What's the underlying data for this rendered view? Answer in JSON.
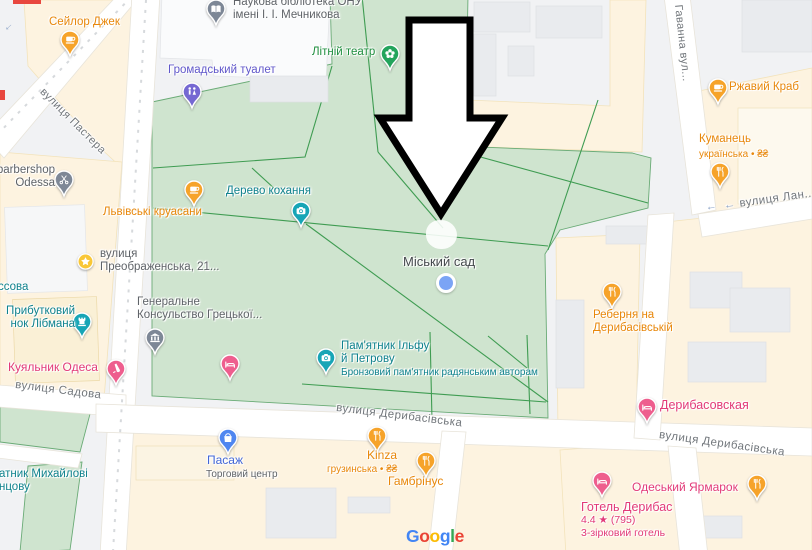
{
  "map": {
    "attribution": {
      "logo_text": "Google",
      "letter_colors": [
        "#4285F4",
        "#EA4335",
        "#FBBC05",
        "#4285F4",
        "#34A853",
        "#EA4335"
      ]
    },
    "annotation": {
      "shape": "arrow",
      "direction": "down",
      "fill": "#ffffff",
      "outline": "#000000"
    },
    "location_dot": {
      "x": 446,
      "y": 283,
      "color": "#7ba4f5"
    },
    "area_labels": [
      {
        "id": "miskyi-sad",
        "text": "Міський сад",
        "x": 403,
        "y": 254,
        "size": 13,
        "color": "#45494d"
      }
    ],
    "street_labels": [
      {
        "id": "pastera",
        "text": "вулиця Пастера",
        "x": 46,
        "y": 86,
        "rotate": 45,
        "size": 11
      },
      {
        "id": "havanna",
        "text": "Гаванна вул...",
        "x": 684,
        "y": 4,
        "rotate": 84,
        "size": 11
      },
      {
        "id": "lan",
        "text": "вулиця Лан...",
        "x": 723,
        "y": 200,
        "rotate": -8,
        "size": 11.5,
        "arrow": true
      },
      {
        "id": "sadova",
        "text": "вулиця Садова",
        "x": 16,
        "y": 379,
        "rotate": 7,
        "size": 11.5
      },
      {
        "id": "derybasivska-center",
        "text": "вулиця Дерибасівська",
        "x": 337,
        "y": 402,
        "rotate": 7,
        "size": 11.5
      },
      {
        "id": "derybasivska-right",
        "text": "вулиця Дерибасівська",
        "x": 660,
        "y": 429,
        "rotate": 8,
        "size": 11.5
      }
    ],
    "oneway_arrows": [
      {
        "x": 4,
        "y": 22,
        "rotate": 137
      },
      {
        "x": 706,
        "y": 203,
        "rotate": 172
      }
    ],
    "pois": [
      {
        "id": "seilor-dzhek",
        "icon": "cafe",
        "pin": {
          "x": 70,
          "y": 40,
          "color": "#f6a32a"
        },
        "labels": [
          {
            "x": 49,
            "y": 16,
            "color": "#e8870a",
            "size": 11.5,
            "lines": [
              "Сейлор Джек"
            ]
          }
        ]
      },
      {
        "id": "naukova-biblioteka",
        "icon": "book",
        "pin": {
          "x": 216,
          "y": 9,
          "color": "#7d8796"
        },
        "labels": [
          {
            "x": 233,
            "y": -4,
            "color": "#5f6368",
            "size": 11.5,
            "lines": [
              "Наукова бібліотека ОНУ",
              "імені І. І. Мечникова"
            ]
          }
        ]
      },
      {
        "id": "hromadskyi-tualet",
        "icon": "toilet",
        "pin": {
          "x": 192,
          "y": 92,
          "color": "#7568d2"
        },
        "labels": [
          {
            "x": 168,
            "y": 64,
            "color": "#6057ca",
            "size": 11.5,
            "lines": [
              "Громадський туалет"
            ]
          }
        ]
      },
      {
        "id": "litnii-teatr",
        "icon": "flower",
        "pin": {
          "x": 390,
          "y": 54,
          "color": "#23a45c"
        },
        "labels": [
          {
            "x": 312,
            "y": 46,
            "color": "#1e8e3e",
            "size": 11.5,
            "lines": [
              "Літній театр"
            ]
          }
        ]
      },
      {
        "id": "rzhavyi-krab",
        "icon": "cafe",
        "pin": {
          "x": 718,
          "y": 88,
          "color": "#f6a32a"
        },
        "labels": [
          {
            "x": 729,
            "y": 81,
            "color": "#e8870a",
            "size": 11.5,
            "lines": [
              "Ржавий Краб"
            ]
          }
        ]
      },
      {
        "id": "kumanets",
        "icon": "restaurant",
        "pin": {
          "x": 720,
          "y": 172,
          "color": "#f6a32a"
        },
        "labels": [
          {
            "x": 699,
            "y": 133,
            "color": "#e8870a",
            "size": 11.5,
            "lines": [
              "Куманець"
            ]
          },
          {
            "x": 699,
            "y": 149,
            "color": "#e8870a",
            "size": 10,
            "weight": 400,
            "lines": [
              "українська • ₴₴"
            ]
          }
        ]
      },
      {
        "id": "lvivski-kruasany",
        "icon": "cafe",
        "pin": {
          "x": 194,
          "y": 190,
          "color": "#f6a32a"
        },
        "labels": [
          {
            "x": 103,
            "y": 206,
            "color": "#e8870a",
            "size": 11.5,
            "lines": [
              "Львівські круасани"
            ]
          }
        ]
      },
      {
        "id": "barbershop-odessa",
        "icon": "scissors",
        "pin": {
          "x": 64,
          "y": 180,
          "color": "#7d8796"
        },
        "labels": [
          {
            "x": -60,
            "y": 164,
            "w": 115,
            "align": "right",
            "color": "#5f6368",
            "size": 11.5,
            "lines": [
              "barbershop",
              "Odessa"
            ]
          }
        ]
      },
      {
        "id": "vulytsia-preobrazhenska-21",
        "icon": "star",
        "pin": {
          "x": 85,
          "y": 261,
          "color": "#f9c737"
        },
        "labels": [
          {
            "x": 100,
            "y": 248,
            "color": "#5f6368",
            "size": 11.5,
            "lines": [
              "вулиця",
              "Преображенська, 21..."
            ]
          }
        ]
      },
      {
        "id": "derevo-kokhannia",
        "icon": "camera",
        "pin": {
          "x": 301,
          "y": 211,
          "color": "#17a5b6"
        },
        "labels": [
          {
            "x": 226,
            "y": 185,
            "color": "#0f828d",
            "size": 11.5,
            "lines": [
              "Дерево кохання"
            ]
          }
        ]
      },
      {
        "id": "ssova-partial",
        "icon": null,
        "pin": null,
        "labels": [
          {
            "x": -2,
            "y": 281,
            "color": "#0f828d",
            "size": 11.5,
            "lines": [
              "ссова"
            ]
          }
        ]
      },
      {
        "id": "prybutkovyi-budynok-libmana",
        "icon": "castle",
        "pin": {
          "x": 82,
          "y": 322,
          "color": "#17a5b6"
        },
        "labels": [
          {
            "x": -41,
            "y": 305,
            "w": 116,
            "align": "right",
            "color": "#0f828d",
            "size": 11.5,
            "lines": [
              "Прибутковий",
              "нок Лібмана"
            ]
          }
        ]
      },
      {
        "id": "heneralne-konsulstvo-hretskoi",
        "icon": "bank",
        "pin": {
          "x": 155,
          "y": 338,
          "color": "#7d8796"
        },
        "labels": [
          {
            "x": 137,
            "y": 296,
            "color": "#5f6368",
            "size": 11.5,
            "lines": [
              "Генеральне",
              "Консульство Грецької..."
            ]
          }
        ]
      },
      {
        "id": "kuialnyk-odesa",
        "icon": "bottle",
        "pin": {
          "x": 116,
          "y": 369,
          "color": "#ee5e8e"
        },
        "labels": [
          {
            "x": 8,
            "y": 361,
            "color": "#e23a78",
            "size": 12,
            "lines": [
              "Куяльник Одеса"
            ]
          }
        ]
      },
      {
        "id": "hotel-pin-unlabeled",
        "icon": "bed",
        "pin": {
          "x": 230,
          "y": 364,
          "color": "#ee5e8e"
        },
        "labels": []
      },
      {
        "id": "pamiatnyk-ilfu-i-petrovu",
        "icon": "camera",
        "pin": {
          "x": 326,
          "y": 358,
          "color": "#17a5b6"
        },
        "labels": [
          {
            "x": 341,
            "y": 340,
            "color": "#0f828d",
            "size": 11.5,
            "lines": [
              "Пам'ятник Ільфу",
              "й Петрову"
            ]
          },
          {
            "x": 341,
            "y": 367,
            "color": "#0f828d",
            "size": 10,
            "weight": 400,
            "lines": [
              "Бронзовий пам'ятник радянським авторам"
            ]
          }
        ]
      },
      {
        "id": "rebernia-na-derybasivskii",
        "icon": "restaurant",
        "pin": {
          "x": 612,
          "y": 292,
          "color": "#f6a32a"
        },
        "labels": [
          {
            "x": 593,
            "y": 309,
            "color": "#e8870a",
            "size": 11.5,
            "lines": [
              "Реберня на",
              "Дерибасівській"
            ]
          }
        ]
      },
      {
        "id": "derybasovskaia",
        "icon": "bed",
        "pin": {
          "x": 647,
          "y": 407,
          "color": "#ee5e8e"
        },
        "labels": [
          {
            "x": 660,
            "y": 398,
            "color": "#e23a78",
            "size": 12.5,
            "lines": [
              "Дерибасовская"
            ]
          }
        ]
      },
      {
        "id": "pasazh",
        "icon": "bag",
        "pin": {
          "x": 228,
          "y": 438,
          "color": "#4f86f0"
        },
        "labels": [
          {
            "x": 207,
            "y": 454,
            "color": "#4166d6",
            "size": 12,
            "lines": [
              "Пасаж"
            ]
          },
          {
            "x": 206,
            "y": 469,
            "color": "#5f6368",
            "size": 10,
            "weight": 400,
            "lines": [
              "Торговий центр"
            ]
          }
        ]
      },
      {
        "id": "kinza",
        "icon": "restaurant",
        "pin": {
          "x": 377,
          "y": 436,
          "color": "#f6a32a"
        },
        "labels": [
          {
            "x": 367,
            "y": 449,
            "color": "#e8870a",
            "size": 12,
            "lines": [
              "Kinza"
            ]
          },
          {
            "x": 327,
            "y": 464,
            "color": "#e8870a",
            "size": 10,
            "weight": 400,
            "lines": [
              "грузинська • ₴₴"
            ]
          }
        ]
      },
      {
        "id": "hambrinus",
        "icon": "restaurant",
        "pin": {
          "x": 426,
          "y": 461,
          "color": "#f6a32a"
        },
        "labels": [
          {
            "x": 388,
            "y": 475,
            "color": "#e8870a",
            "size": 12,
            "lines": [
              "Гамбрінус"
            ]
          }
        ]
      },
      {
        "id": "odeskyi-yarmarok",
        "icon": "restaurant",
        "pin": {
          "x": 757,
          "y": 484,
          "color": "#f6a32a"
        },
        "labels": [
          {
            "x": 632,
            "y": 481,
            "color": "#e23a78",
            "size": 12,
            "lines": [
              "Одеський Ярмарок"
            ]
          }
        ]
      },
      {
        "id": "hotel-derybas",
        "icon": "bed",
        "pin": {
          "x": 602,
          "y": 481,
          "color": "#ee5e8e"
        },
        "labels": [
          {
            "x": 581,
            "y": 500,
            "color": "#e23a78",
            "size": 12.5,
            "lines": [
              "Готель Дерибас"
            ]
          },
          {
            "x": 581,
            "y": 515,
            "color": "#e23a78",
            "size": 10.5,
            "weight": 400,
            "lines": [
              "4.4 ★ (795)"
            ]
          },
          {
            "x": 581,
            "y": 528,
            "color": "#e23a78",
            "size": 10.5,
            "weight": 400,
            "lines": [
              "3-зірковий готель"
            ]
          }
        ]
      },
      {
        "id": "pamiatnyk-mykhailovi-partial",
        "icon": null,
        "pin": null,
        "labels": [
          {
            "x": -1,
            "y": 468,
            "color": "#0f828d",
            "size": 11.5,
            "lines": [
              "атник Михайлові",
              "нцову"
            ]
          }
        ]
      }
    ]
  }
}
